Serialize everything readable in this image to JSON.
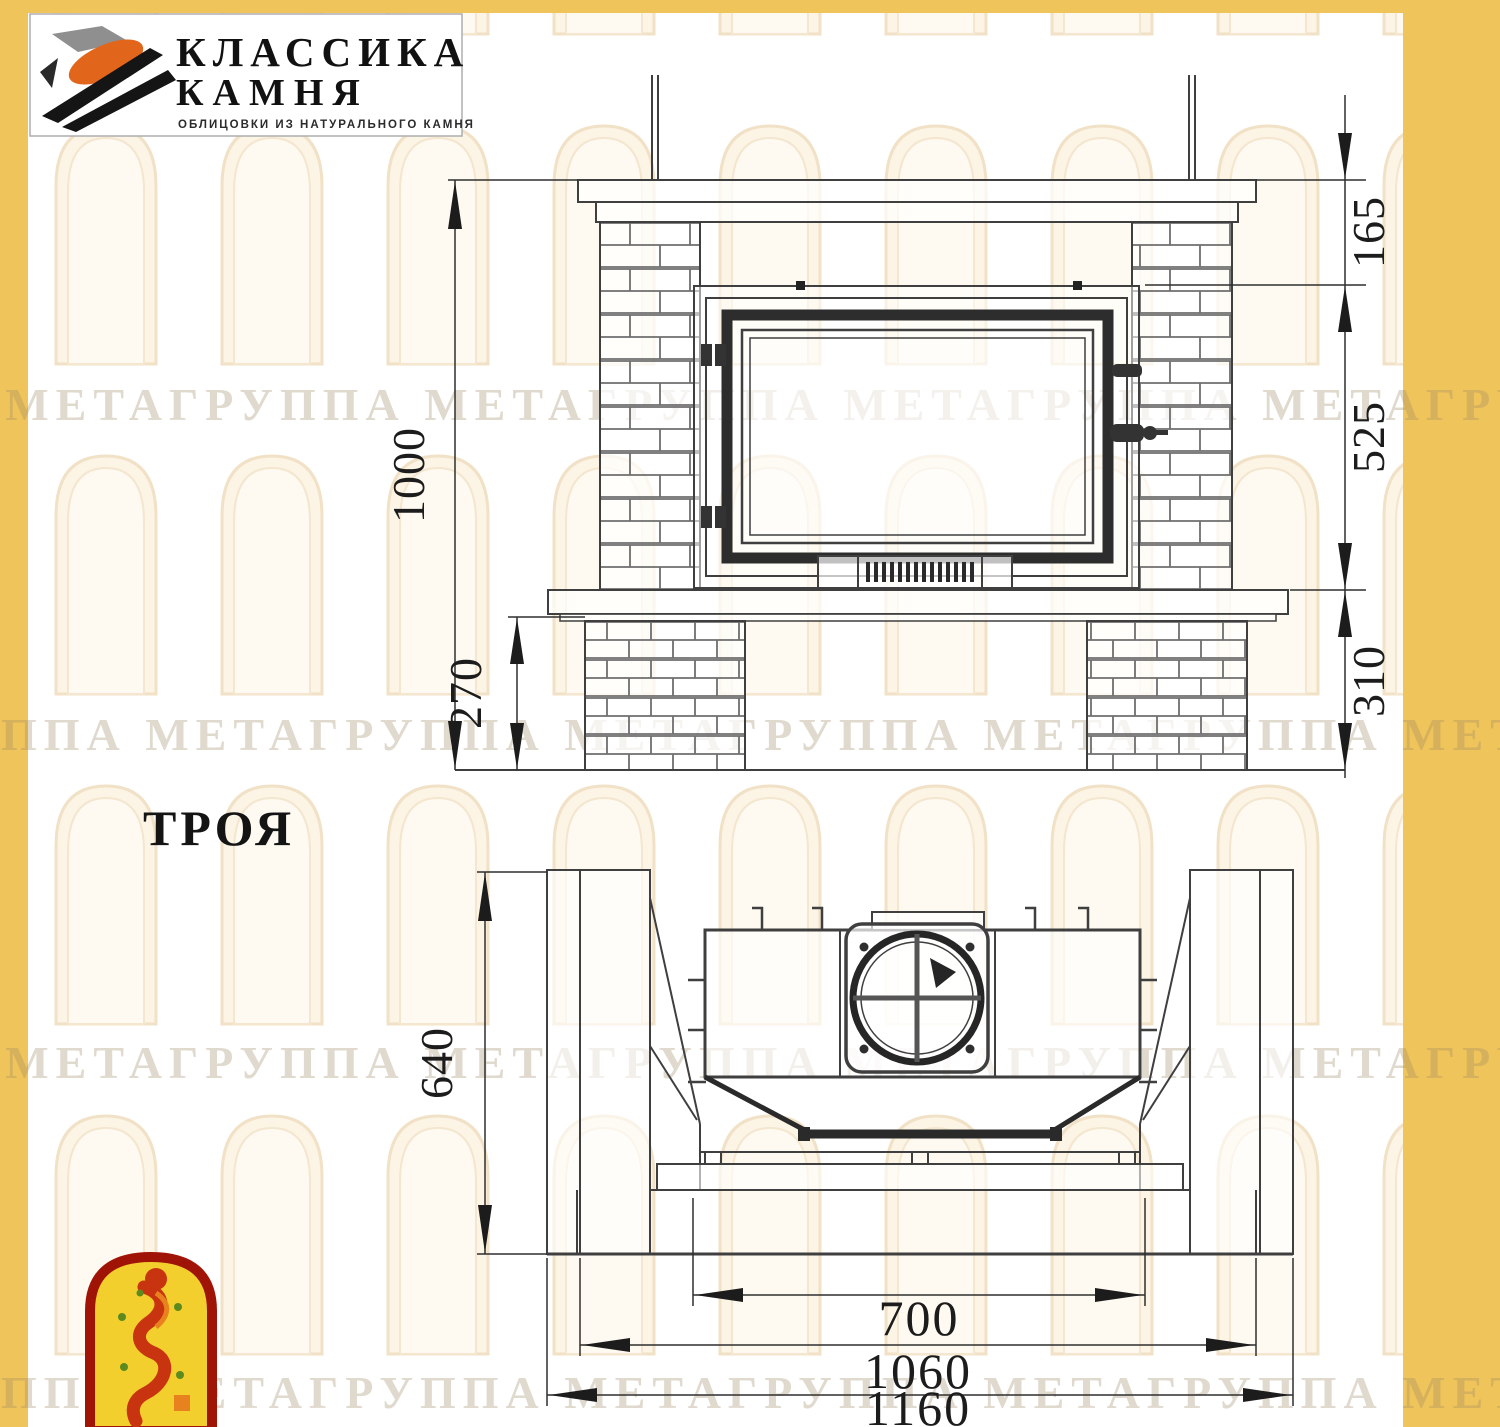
{
  "header_logo": {
    "line1": "КЛАССИКА",
    "line2": "КАМНЯ",
    "tagline": "ОБЛИЦОВКИ ИЗ НАТУРАЛЬНОГО КАМНЯ"
  },
  "model": {
    "name": "ТРОЯ"
  },
  "watermark": {
    "text": "ГРУППА МЕТАГРУППА МЕТАГРУППА МЕТАГРУППА МЕТАГРУППА МЕТА"
  },
  "front_view": {
    "dims": {
      "total_height": "1000",
      "top_to_insert": "165",
      "insert_height": "525",
      "hearth_to_floor": "310",
      "pedestal_height": "270"
    }
  },
  "plan_view": {
    "dims": {
      "depth": "640",
      "opening_width": "700",
      "base_width": "1060",
      "overall_width": "1160"
    }
  },
  "colors": {
    "band_yellow": "#efc45a",
    "drawing_line": "#3f3f3f",
    "emblem_red": "#a01407",
    "emblem_yellow": "#f3cf2e",
    "logo_orange": "#e2651c"
  }
}
